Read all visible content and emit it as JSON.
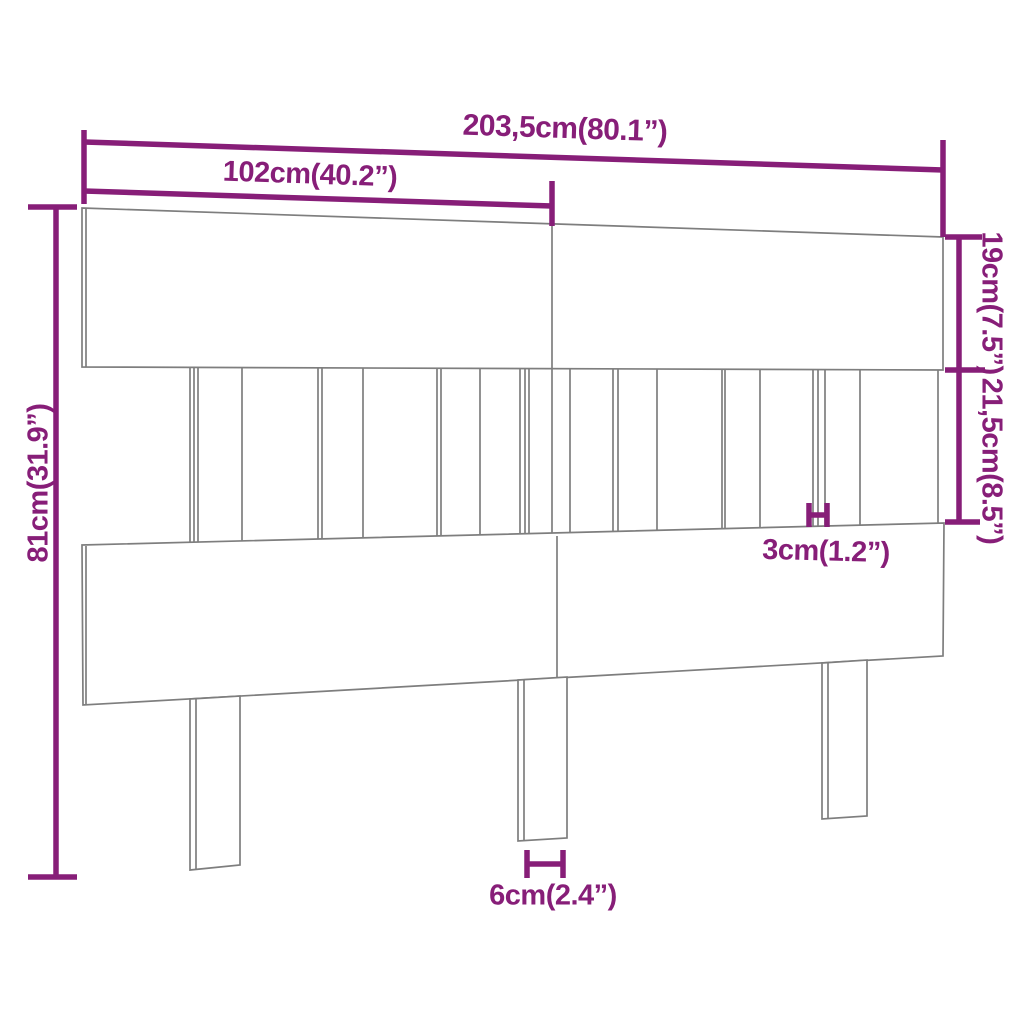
{
  "colors": {
    "dimension_purple": "#871E78",
    "drawing_gray": "#7E7E7E",
    "background": "#FFFFFF"
  },
  "labels": {
    "total_width": "203,5cm(80.1”)",
    "half_width": "102cm(40.2”)",
    "top_board_height": "19cm(7.5”)",
    "middle_section_height": "21,5cm(8.5”)",
    "total_height": "81cm(31.9”)",
    "slat_gap": "3cm(1.2”)",
    "leg_width": "6cm(2.4”)"
  },
  "drawing": {
    "viewbox": "0 0 1024 1024",
    "polygons": [
      {
        "name": "headboard-top-board",
        "points": "82,208 943,237 943,370 82,367"
      },
      {
        "name": "headboard-bottom-board",
        "points": "82,545 944,523 943,656 83,705"
      },
      {
        "name": "headboard-leg-left",
        "points": "190,699 240,696 240,865 190,870"
      },
      {
        "name": "headboard-leg-center",
        "points": "518,680 567,677 567,838 518,841"
      },
      {
        "name": "headboard-leg-right",
        "points": "822,663 867,660 867,816 822,819"
      }
    ],
    "gray_lines": [
      [
        86,
        209,
        86,
        367
      ],
      [
        552,
        224,
        552,
        369
      ],
      [
        86,
        546,
        86,
        704
      ],
      [
        557,
        536,
        557,
        677
      ],
      [
        196,
        699,
        196,
        869
      ],
      [
        524,
        680,
        524,
        840
      ],
      [
        828,
        663,
        828,
        818
      ],
      [
        190,
        367,
        190,
        542
      ],
      [
        194,
        367,
        194,
        542
      ],
      [
        198,
        367,
        198,
        542
      ],
      [
        242,
        368,
        242,
        541
      ],
      [
        318,
        368,
        318,
        539
      ],
      [
        322,
        368,
        322,
        539
      ],
      [
        363,
        368,
        363,
        538
      ],
      [
        437,
        368,
        437,
        536
      ],
      [
        441,
        368,
        441,
        536
      ],
      [
        480,
        368,
        480,
        535
      ],
      [
        520,
        369,
        520,
        534
      ],
      [
        525,
        369,
        525,
        534
      ],
      [
        529,
        369,
        529,
        534
      ],
      [
        552,
        369,
        552,
        533
      ],
      [
        570,
        369,
        570,
        533
      ],
      [
        613,
        369,
        613,
        531
      ],
      [
        618,
        369,
        618,
        531
      ],
      [
        657,
        369,
        657,
        530
      ],
      [
        722,
        369,
        722,
        529
      ],
      [
        725,
        369,
        725,
        529
      ],
      [
        760,
        369,
        760,
        528
      ],
      [
        813,
        370,
        813,
        526
      ],
      [
        818,
        370,
        818,
        526
      ],
      [
        825,
        370,
        825,
        526
      ],
      [
        860,
        370,
        860,
        525
      ],
      [
        938,
        370,
        938,
        523
      ]
    ],
    "dimension_lines": [
      {
        "name": "dim-total-width-line",
        "pts": [
          84,
          142,
          943,
          170
        ]
      },
      {
        "name": "dim-total-width-tick-left",
        "pts": [
          84,
          130,
          84,
          204
        ]
      },
      {
        "name": "dim-total-width-tick-right",
        "pts": [
          943,
          140,
          943,
          237
        ]
      },
      {
        "name": "dim-half-width-line",
        "pts": [
          84,
          191,
          552,
          206
        ]
      },
      {
        "name": "dim-half-width-tick-right",
        "pts": [
          552,
          181,
          552,
          226
        ]
      },
      {
        "name": "dim-top-board-line",
        "pts": [
          959,
          237,
          959,
          370
        ]
      },
      {
        "name": "dim-top-board-tick-top",
        "pts": [
          945,
          237,
          982,
          237
        ]
      },
      {
        "name": "dim-shared-tick-middle",
        "pts": [
          945,
          370,
          985,
          370
        ]
      },
      {
        "name": "dim-middle-section-line",
        "pts": [
          959,
          370,
          959,
          522
        ]
      },
      {
        "name": "dim-middle-section-tick-bottom",
        "pts": [
          945,
          522,
          980,
          522
        ]
      },
      {
        "name": "dim-total-height-line",
        "pts": [
          56,
          207,
          56,
          877
        ]
      },
      {
        "name": "dim-total-height-tick-top",
        "pts": [
          28,
          207,
          77,
          207
        ]
      },
      {
        "name": "dim-total-height-tick-bottom",
        "pts": [
          28,
          877,
          77,
          877
        ]
      },
      {
        "name": "dim-slat-gap-tick-left",
        "pts": [
          809,
          503,
          809,
          527
        ]
      },
      {
        "name": "dim-slat-gap-tick-right",
        "pts": [
          827,
          503,
          827,
          527
        ]
      },
      {
        "name": "dim-slat-gap-bar",
        "pts": [
          809,
          515,
          827,
          515
        ]
      },
      {
        "name": "dim-leg-width-tick-left",
        "pts": [
          527,
          850,
          527,
          878
        ]
      },
      {
        "name": "dim-leg-width-tick-right",
        "pts": [
          563,
          850,
          563,
          878
        ]
      },
      {
        "name": "dim-leg-width-bar",
        "pts": [
          527,
          864,
          563,
          864
        ]
      }
    ]
  }
}
